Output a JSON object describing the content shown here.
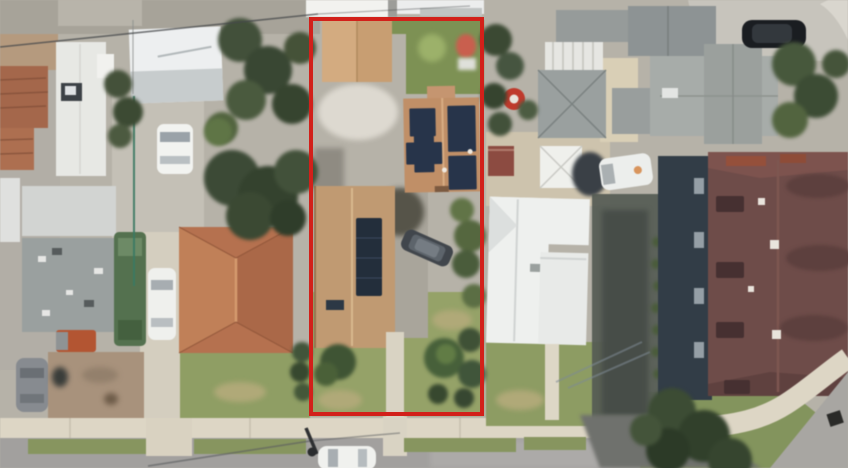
{
  "scene": {
    "type": "satellite-aerial-photo",
    "description": "Overhead satellite photo of a residential block. A red rectangle outlines a deep narrow parcel containing a detached tan garage, two brown-roofed houses with dark rooftop solar panels, a central driveway with a parked dark SUV, lawn, shrubs and a front walkway to the street. Neighboring lots show terracotta, gray, white and dark-maroon roofs, trees, parked cars, a dirt yard, sidewalks, parkway grass strips and an asphalt street along the bottom with a corner sidewalk at lower right.",
    "annotation": {
      "name": "parcel-boundary",
      "shape": "rectangle",
      "color": "#d2201a",
      "stroke_width": 4
    }
  },
  "palette": {
    "asphalt": "#a2a09e",
    "sidewalk": "#ddd6c5",
    "concrete": "#b6b2a8",
    "grass": "#8f9e64",
    "dry_grass": "#b0a978",
    "dirt": "#a8927c",
    "tree_dark": "#3d4a33",
    "tree_mid": "#566844",
    "terracotta_roof": "#b5714f",
    "tan_roof": "#c89e72",
    "white_roof": "#eef0ee",
    "gray_roof": "#9aa09f",
    "maroon_roof": "#6e4c49",
    "solar_panel": "#27344a"
  },
  "objects": {
    "vehicles": [
      "white-car-driveway",
      "white-sedan",
      "green-trailer-truck",
      "orange-truck",
      "gray-car",
      "dark-suv-in-lot",
      "white-car-street",
      "black-suv-top-right",
      "white-van-right"
    ],
    "landmarks": [
      "detached-garage",
      "solar-house-upper",
      "solar-house-lower",
      "terracotta-house",
      "white-house-left",
      "white-house-right",
      "gray-pyramid-house",
      "maroon-apartment",
      "red-ball",
      "corner-sidewalk"
    ]
  }
}
